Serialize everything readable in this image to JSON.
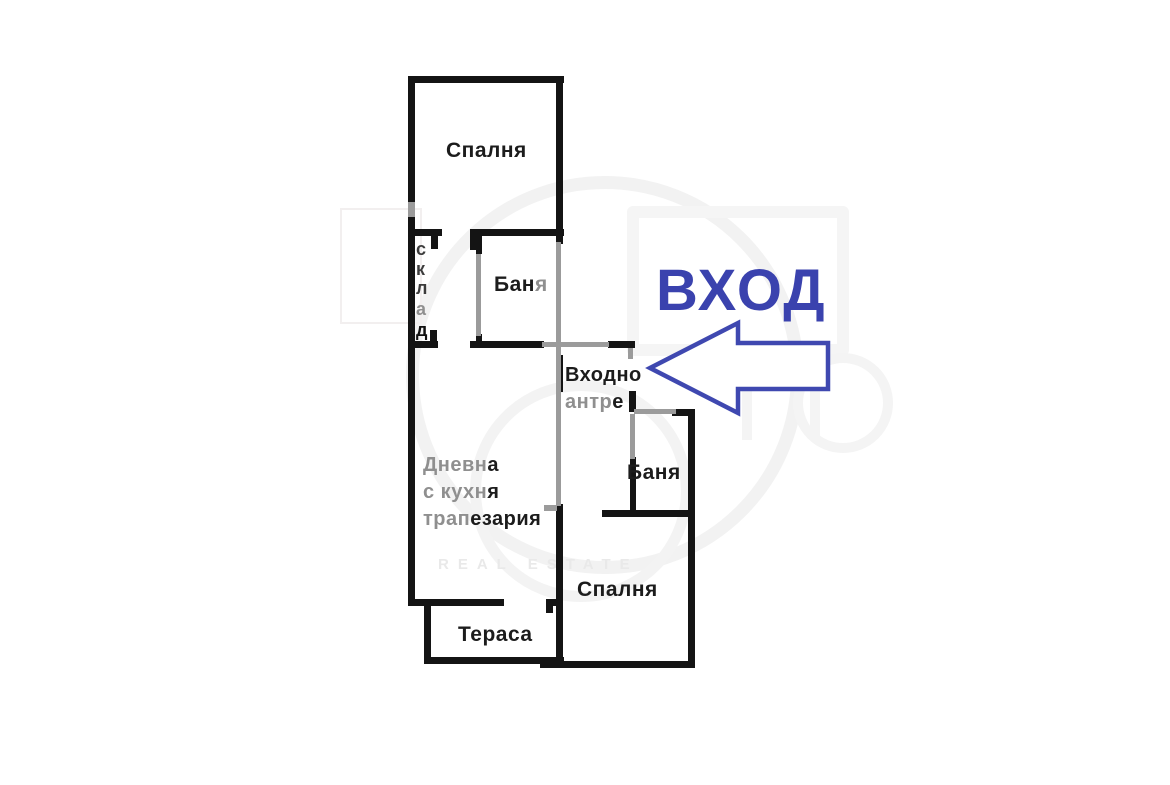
{
  "entrance": {
    "sign": "ВХОД",
    "arrow_color": "#3f48b0",
    "sign_color": "#3a42ae"
  },
  "rooms": {
    "bedroom_top": "Спалня",
    "bath_top": {
      "black": "Бан",
      "gray": "я"
    },
    "storage": {
      "l1": "с",
      "l2": "к",
      "l3": "л",
      "l4": "а",
      "l5": "д"
    },
    "entry_hall": {
      "line1": "Входно",
      "line2_gray": "антр",
      "line2_black": "е"
    },
    "living": {
      "l1_gray": "Дневн",
      "l1_black": "а",
      "l2_gray": "с кухн",
      "l2_black": "я",
      "l3_gray": "трап",
      "l3_black": "езария"
    },
    "bath_right": "Баня",
    "bedroom_bottom": "Спалня",
    "terrace": "Тераса"
  },
  "watermark": {
    "text": "REAL ESTATE"
  },
  "colors": {
    "wall": "#141414",
    "partition_gray": "#9b9b9b",
    "label_gray": "#8f8f8f",
    "background": "#ffffff"
  }
}
